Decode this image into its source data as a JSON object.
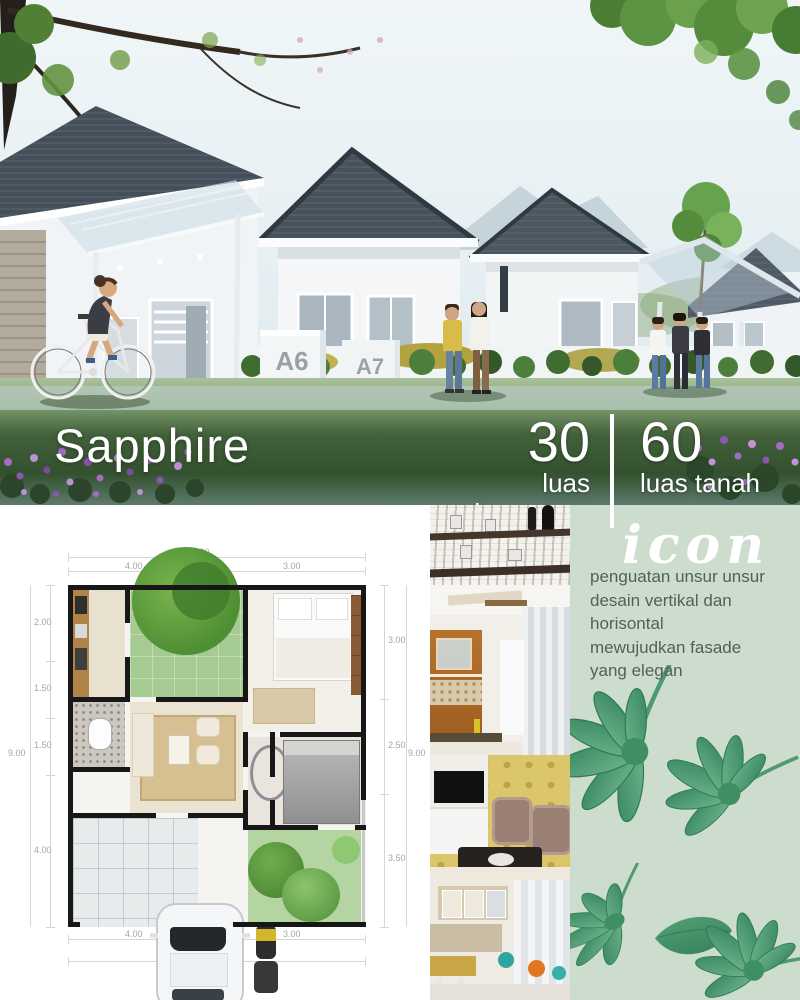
{
  "hero": {
    "title": "Sapphire",
    "stats": [
      {
        "value": "30",
        "label": "luas bangunan"
      },
      {
        "value": "60",
        "label": "luas tanah"
      }
    ],
    "house_markers": [
      "A6",
      "A7"
    ]
  },
  "floorplan": {
    "dims": {
      "top_total": "7.60",
      "top_a": "4.00",
      "top_b": "3.00",
      "left_a": "2.00",
      "left_b": "1.50",
      "left_c": "1.50",
      "left_d": "4.00",
      "left_total": "9.00",
      "right_a": "3.00",
      "right_b": "2.50",
      "right_c": "3.50",
      "right_total": "9.00",
      "bottom_a": "4.00",
      "bottom_b": "3.00",
      "bottom_total": "7.60"
    }
  },
  "panel": {
    "heading": "icon",
    "description_lines": [
      "penguatan unsur unsur",
      "desain vertikal dan",
      "horisontal",
      "mewujudkan fasade",
      "yang elegan"
    ]
  },
  "colors": {
    "panel_bg": "#ccdccd",
    "leaf_green": "#57a377",
    "roof_gray": "#4a555f",
    "heading_white": "#ffffff",
    "description_text": "#51615a",
    "dim_text": "#a6a6a6"
  }
}
